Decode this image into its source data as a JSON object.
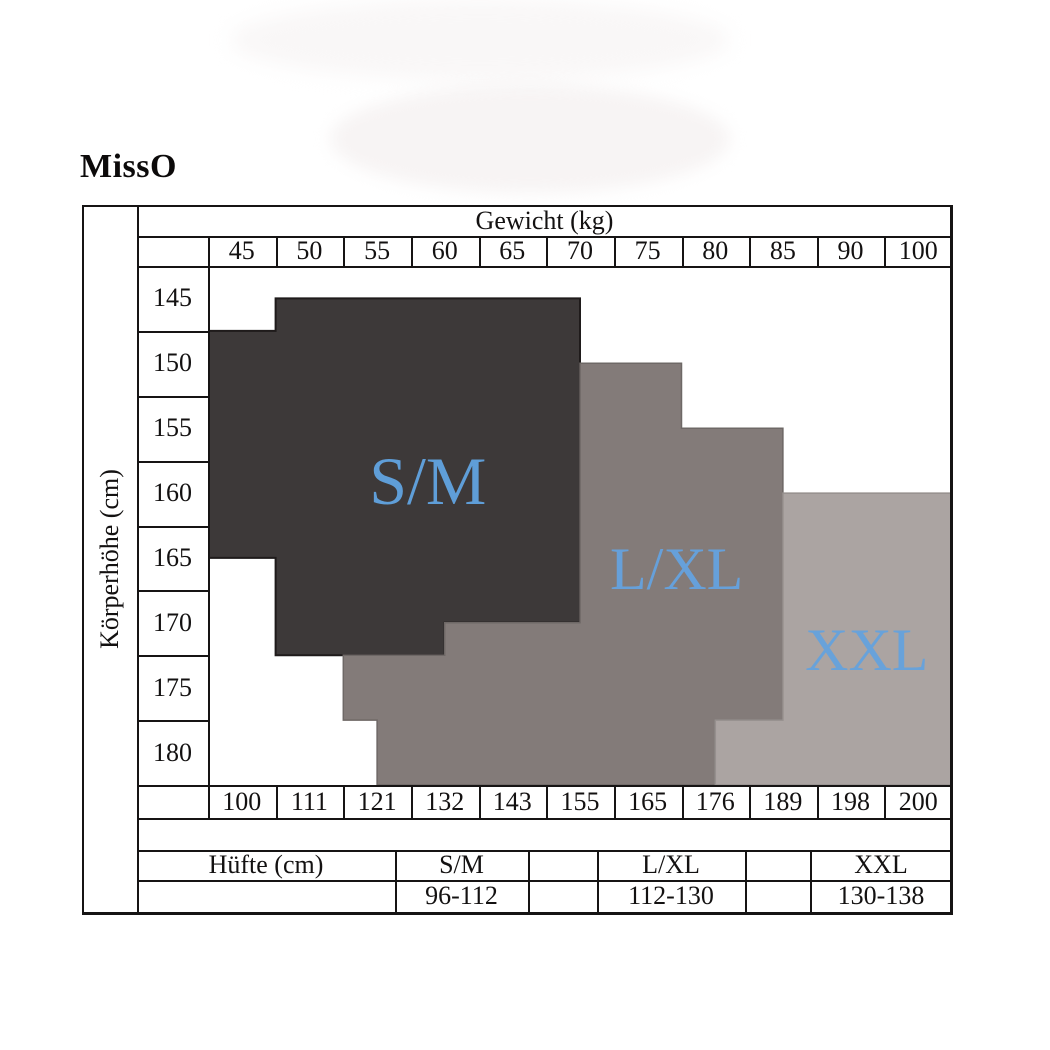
{
  "brand": "MissO",
  "chart_data": {
    "type": "heatmap",
    "title": "",
    "x_axis": {
      "label": "Gewicht (kg)",
      "position": "top",
      "ticks": [
        "45",
        "50",
        "55",
        "60",
        "65",
        "70",
        "75",
        "80",
        "85",
        "90",
        "100"
      ]
    },
    "y_axis": {
      "label": "Körperhöhe (cm)",
      "position": "left",
      "ticks": [
        "145",
        "150",
        "155",
        "160",
        "165",
        "170",
        "175",
        "180"
      ]
    },
    "x_axis_bottom": {
      "label": "",
      "ticks": [
        "100",
        "111",
        "121",
        "132",
        "143",
        "155",
        "165",
        "176",
        "189",
        "198",
        "200"
      ]
    },
    "grid": {
      "columns": 11,
      "rows": 8,
      "gridlines_in_plot": false
    },
    "regions": [
      {
        "name": "S/M",
        "fill": "#3d3939",
        "edge": "#1f1b1b",
        "label_color": "#5f9ed8",
        "label_font_px": 68,
        "label_anchor_units": [
          3.25,
          3.32
        ],
        "polygon_units": [
          [
            1,
            0.5
          ],
          [
            5.5,
            0.5
          ],
          [
            5.5,
            5.5
          ],
          [
            3.5,
            5.5
          ],
          [
            3.5,
            6
          ],
          [
            1,
            6
          ],
          [
            1,
            4.5
          ],
          [
            0,
            4.5
          ],
          [
            0,
            1
          ],
          [
            1,
            1
          ]
        ]
      },
      {
        "name": "L/XL",
        "fill": "#837b79",
        "edge": "#6e6866",
        "label_color": "#66a0da",
        "label_font_px": 60,
        "label_anchor_units": [
          6.93,
          4.67
        ],
        "polygon_units": [
          [
            5.5,
            1.5
          ],
          [
            7,
            1.5
          ],
          [
            7,
            2.5
          ],
          [
            8.5,
            2.5
          ],
          [
            8.5,
            7
          ],
          [
            7.5,
            7
          ],
          [
            7.5,
            8
          ],
          [
            2.5,
            8
          ],
          [
            2.5,
            7
          ],
          [
            2,
            7
          ],
          [
            2,
            6
          ],
          [
            3.5,
            6
          ],
          [
            3.5,
            5.5
          ],
          [
            5.5,
            5.5
          ]
        ]
      },
      {
        "name": "XXL",
        "fill": "#aba4a2",
        "edge": "#96908e",
        "label_color": "#68a2da",
        "label_font_px": 60,
        "label_anchor_units": [
          9.74,
          5.92
        ],
        "polygon_units": [
          [
            8.5,
            3.5
          ],
          [
            11,
            3.5
          ],
          [
            11,
            8
          ],
          [
            7.5,
            8
          ],
          [
            7.5,
            7
          ],
          [
            8.5,
            7
          ]
        ]
      }
    ],
    "hip_table": {
      "header": "Hüfte (cm)",
      "entries": [
        {
          "size": "S/M",
          "range": "96-112"
        },
        {
          "size": "L/XL",
          "range": "112-130"
        },
        {
          "size": "XXL",
          "range": "130-138"
        }
      ]
    }
  },
  "colors": {
    "border": "#161414",
    "background": "#ffffff",
    "accent_blue": "#5f9ed8"
  }
}
